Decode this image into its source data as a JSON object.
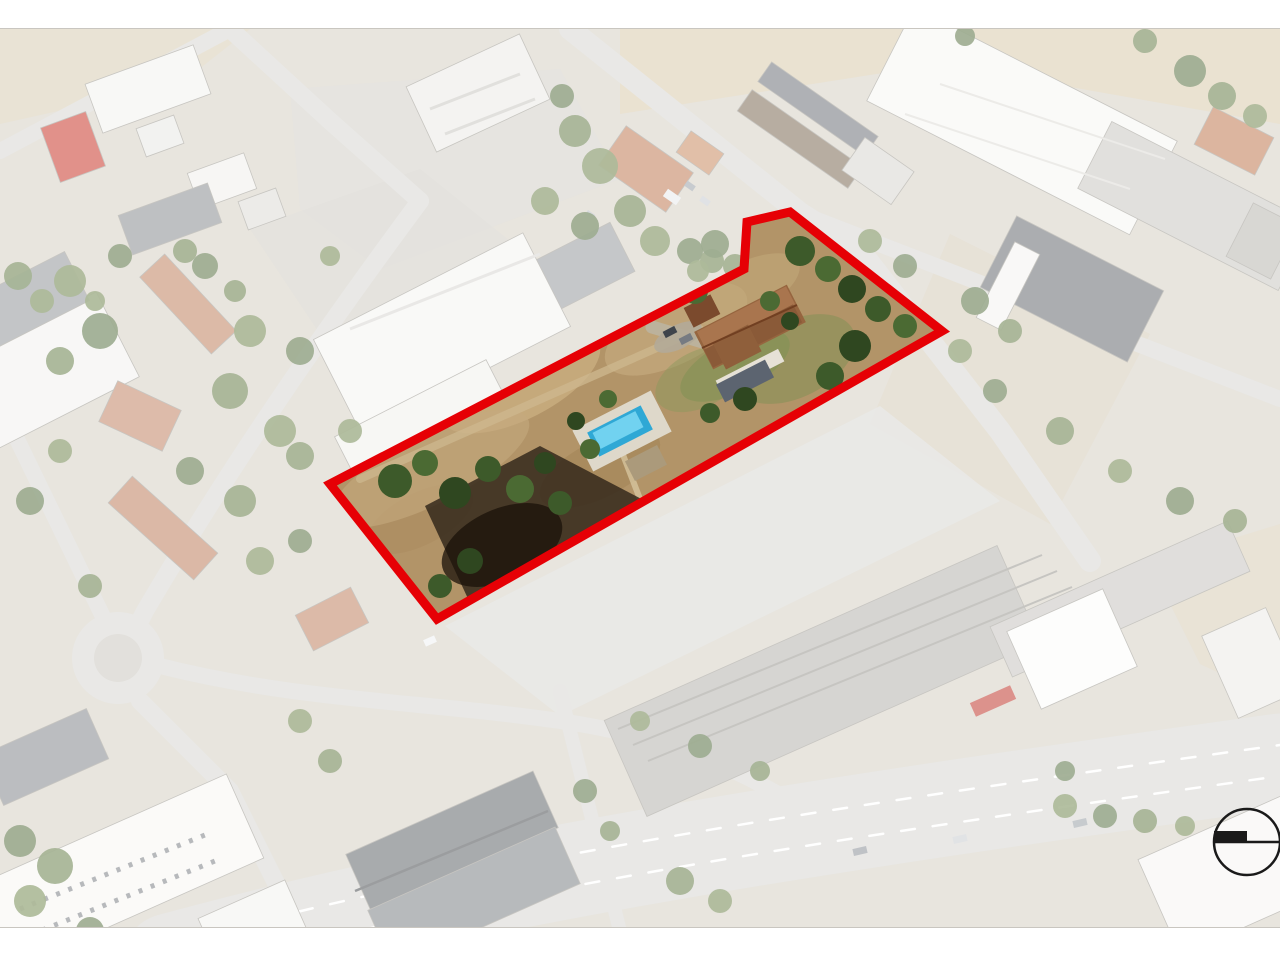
{
  "page": {
    "background": "#ffffff",
    "top_margin": 28,
    "bottom_margin": 32
  },
  "map": {
    "type": "aerial-photo",
    "base_color": "#d5cfc3",
    "washout": {
      "color": "#ffffff",
      "opacity": 0.45
    },
    "fields": [
      {
        "points": "620,0 1280,0 1280,95 940,35 620,85",
        "fill": "#d9c9a4",
        "op": 0.75
      },
      {
        "points": "0,0 250,0 180,55 0,95",
        "fill": "#d8cba8",
        "op": 0.6
      },
      {
        "points": "950,205 1150,305 1050,495 870,395",
        "fill": "#d3c6a6",
        "op": 0.45
      },
      {
        "points": "1150,535 1280,495 1280,672 1200,635",
        "fill": "#d8cba8",
        "op": 0.55
      },
      {
        "points": "290,60 560,40 620,150 380,240 300,180",
        "fill": "#cfcdc8",
        "op": 0.7
      },
      {
        "points": "250,200 420,140 520,220 330,320",
        "fill": "#ccc9c3",
        "op": 0.6
      },
      {
        "points": "445,597 880,377 1000,472 560,687",
        "fill": "#d8d7d3",
        "op": 0.9
      }
    ],
    "roads": [
      {
        "d": "M 570 0 L 800 184 L 860 222 L 1000 402 L 1090 532",
        "w": 22
      },
      {
        "d": "M 812 189 L 1280 370",
        "w": 16
      },
      {
        "d": "M 230 0 L 330 92 L 420 172",
        "w": 18
      },
      {
        "d": "M 0 122 L 230 0",
        "w": 16
      },
      {
        "d": "M 420 172 C 340 280 240 420 145 582 L 122 627",
        "w": 18
      },
      {
        "d": "M 0 375 L 122 627",
        "w": 16
      },
      {
        "d": "M 140 672 L 230 762 L 300 902",
        "w": 18
      },
      {
        "d": "M 160 637 C 300 672 420 672 560 692 C 700 712 780 762 850 812",
        "w": 16
      },
      {
        "d": "M 560 662 L 620 902",
        "w": 14
      },
      {
        "d": "M 430 898 C 650 856 900 818 1150 786",
        "w": 20
      },
      {
        "d": "M 170 932 C 500 842 850 792 1280 732",
        "w": 95
      }
    ],
    "road_color": "#d7d5d1",
    "lane_dashes": [
      {
        "d": "M 175 914 C 500 826 850 776 1280 716"
      },
      {
        "d": "M 180 947 C 505 857 855 807 1280 747"
      }
    ],
    "dash_color": "#ffffff",
    "roundabout": {
      "x": 118,
      "y": 629,
      "r_outer": 46,
      "r_inner": 24,
      "outer": "#d8d6d2",
      "inner": "#cbc7bf"
    },
    "buildings": [
      [
        148,
        60,
        115,
        52,
        -20,
        "#f3f2ef"
      ],
      [
        73,
        118,
        48,
        58,
        -20,
        "#c8372b"
      ],
      [
        160,
        107,
        40,
        30,
        -20,
        "#e8e7e3"
      ],
      [
        222,
        152,
        60,
        38,
        -20,
        "#f0efeb"
      ],
      [
        170,
        190,
        95,
        42,
        -20,
        "#898d91"
      ],
      [
        262,
        180,
        40,
        30,
        -20,
        "#dddbd6"
      ],
      [
        478,
        64,
        125,
        72,
        -25,
        "#eceae5"
      ],
      [
        646,
        140,
        82,
        48,
        35,
        "#bf7a55"
      ],
      [
        700,
        124,
        40,
        26,
        35,
        "#c98a62"
      ],
      [
        800,
        110,
        135,
        26,
        35,
        "#7d6b55"
      ],
      [
        818,
        80,
        130,
        24,
        35,
        "#6e7278"
      ],
      [
        878,
        142,
        60,
        40,
        35,
        "#d8d5cf"
      ],
      [
        1022,
        92,
        295,
        105,
        27,
        "#f6f6f3"
      ],
      [
        1195,
        177,
        225,
        75,
        27,
        "#c8c6c2"
      ],
      [
        1072,
        260,
        165,
        80,
        27,
        "#676b70"
      ],
      [
        1008,
        257,
        28,
        85,
        27,
        "#f4f3f0"
      ],
      [
        1234,
        112,
        68,
        42,
        27,
        "#c07850"
      ],
      [
        1262,
        212,
        50,
        60,
        27,
        "#b9b6b0"
      ],
      [
        520,
        270,
        230,
        55,
        -27,
        "#96999d"
      ],
      [
        442,
        304,
        235,
        105,
        -27,
        "#f5f4f1"
      ],
      [
        428,
        404,
        170,
        78,
        -27,
        "#f1f0ec"
      ],
      [
        42,
        344,
        170,
        95,
        -27,
        "#f2f1ee"
      ],
      [
        28,
        272,
        110,
        55,
        -27,
        "#92959a"
      ],
      [
        188,
        275,
        105,
        34,
        47,
        "#c08160"
      ],
      [
        140,
        387,
        70,
        45,
        25,
        "#c28365"
      ],
      [
        163,
        499,
        115,
        36,
        42,
        "#bd7e5e"
      ],
      [
        332,
        590,
        62,
        40,
        -27,
        "#c08162"
      ],
      [
        45,
        728,
        115,
        55,
        -24,
        "#84878c"
      ],
      [
        108,
        848,
        300,
        92,
        -24,
        "#f7f6f3"
      ],
      [
        252,
        894,
        95,
        52,
        -24,
        "#f3f2ee"
      ],
      [
        452,
        812,
        205,
        62,
        -24,
        "#62666a"
      ],
      [
        474,
        868,
        205,
        62,
        -24,
        "#7d8185"
      ],
      [
        822,
        652,
        430,
        105,
        -24,
        "#b4b2ae"
      ],
      [
        1120,
        570,
        260,
        55,
        -24,
        "#c6c4c0"
      ],
      [
        1072,
        620,
        105,
        85,
        -24,
        "#fbfbfa"
      ],
      [
        1252,
        634,
        70,
        90,
        -24,
        "#eceae5"
      ],
      [
        1237,
        844,
        170,
        105,
        -24,
        "#f6f5f2"
      ]
    ],
    "roof_lines": [
      {
        "d": "M 618 700 L 1042 526",
        "c": "#97958f",
        "w": 2
      },
      {
        "d": "M 633 716 L 1057 542",
        "c": "#97958f",
        "w": 2
      },
      {
        "d": "M 648 732 L 1072 558",
        "c": "#97958f",
        "w": 2
      },
      {
        "d": "M 940 55 L 1165 130",
        "c": "#dcdad5",
        "w": 2
      },
      {
        "d": "M 905 85 L 1130 160",
        "c": "#dcdad5",
        "w": 2
      },
      {
        "d": "M 355 862 L 548 782",
        "c": "#4a4d50",
        "w": 2.5
      },
      {
        "d": "M 20 880 L 205 806",
        "c": "#7d8085",
        "w": 5,
        "dash": "4 9"
      },
      {
        "d": "M 30 906 L 215 832",
        "c": "#7d8085",
        "w": 5,
        "dash": "4 9"
      },
      {
        "d": "M 350 300 L 540 225",
        "c": "#d8d6d1",
        "w": 3
      },
      {
        "d": "M 430 80 L 520 45",
        "c": "#c9c7c2",
        "w": 3
      },
      {
        "d": "M 445 105 L 535 70",
        "c": "#c9c7c2",
        "w": 3
      }
    ],
    "vehicles": [
      [
        690,
        157,
        10,
        6,
        35,
        "#9aa0a8"
      ],
      [
        705,
        172,
        10,
        6,
        35,
        "#c6cacf"
      ],
      [
        672,
        168,
        16,
        9,
        35,
        "#e8eaec"
      ],
      [
        590,
        186,
        9,
        6,
        35,
        "#b7bcc2"
      ],
      [
        430,
        612,
        12,
        7,
        -24,
        "#eef0f2"
      ],
      [
        860,
        822,
        14,
        7,
        -13,
        "#8b9097"
      ],
      [
        960,
        810,
        14,
        7,
        -13,
        "#c9ccd0"
      ],
      [
        1080,
        794,
        14,
        7,
        -13,
        "#9aa0a6"
      ],
      [
        993,
        672,
        44,
        15,
        -24,
        "#c03a2e"
      ]
    ],
    "trees": {
      "colors": [
        "#5e7740",
        "#6b8248",
        "#4f6a38"
      ],
      "items": [
        [
          18,
          247,
          14
        ],
        [
          42,
          272,
          12
        ],
        [
          205,
          237,
          13
        ],
        [
          235,
          262,
          11
        ],
        [
          330,
          227,
          10
        ],
        [
          562,
          67,
          12
        ],
        [
          575,
          102,
          16
        ],
        [
          600,
          137,
          18
        ],
        [
          585,
          197,
          14
        ],
        [
          630,
          182,
          16
        ],
        [
          655,
          212,
          15
        ],
        [
          690,
          222,
          13
        ],
        [
          712,
          232,
          12
        ],
        [
          545,
          172,
          14
        ],
        [
          715,
          215,
          14
        ],
        [
          735,
          237,
          12
        ],
        [
          698,
          242,
          11
        ],
        [
          120,
          227,
          12
        ],
        [
          185,
          222,
          12
        ],
        [
          95,
          272,
          10
        ],
        [
          1190,
          42,
          16
        ],
        [
          1222,
          67,
          14
        ],
        [
          1255,
          87,
          12
        ],
        [
          965,
          7,
          10
        ],
        [
          1145,
          12,
          12
        ],
        [
          960,
          322,
          12
        ],
        [
          995,
          362,
          12
        ],
        [
          1060,
          402,
          14
        ],
        [
          1120,
          442,
          12
        ],
        [
          1180,
          472,
          14
        ],
        [
          1235,
          492,
          12
        ],
        [
          70,
          252,
          16
        ],
        [
          100,
          302,
          18
        ],
        [
          60,
          332,
          14
        ],
        [
          250,
          302,
          16
        ],
        [
          300,
          322,
          14
        ],
        [
          230,
          362,
          18
        ],
        [
          280,
          402,
          16
        ],
        [
          190,
          442,
          14
        ],
        [
          240,
          472,
          16
        ],
        [
          60,
          422,
          12
        ],
        [
          30,
          472,
          14
        ],
        [
          90,
          557,
          12
        ],
        [
          260,
          532,
          14
        ],
        [
          300,
          512,
          12
        ],
        [
          300,
          427,
          14
        ],
        [
          350,
          402,
          12
        ],
        [
          20,
          812,
          16
        ],
        [
          55,
          837,
          18
        ],
        [
          30,
          872,
          16
        ],
        [
          90,
          902,
          14
        ],
        [
          330,
          732,
          12
        ],
        [
          300,
          692,
          12
        ],
        [
          585,
          762,
          12
        ],
        [
          610,
          802,
          10
        ],
        [
          640,
          692,
          10
        ],
        [
          700,
          717,
          12
        ],
        [
          760,
          742,
          10
        ],
        [
          1065,
          777,
          12
        ],
        [
          1105,
          787,
          12
        ],
        [
          1145,
          792,
          12
        ],
        [
          1185,
          797,
          10
        ],
        [
          1065,
          742,
          10
        ],
        [
          680,
          852,
          14
        ],
        [
          720,
          872,
          12
        ],
        [
          975,
          272,
          14
        ],
        [
          1010,
          302,
          12
        ],
        [
          870,
          212,
          12
        ],
        [
          905,
          237,
          12
        ]
      ]
    }
  },
  "parcel": {
    "outline_color": "#e60005",
    "outline_width": 9,
    "polygon": [
      [
        330,
        455
      ],
      [
        744,
        240
      ],
      [
        747,
        193
      ],
      [
        790,
        183
      ],
      [
        942,
        302
      ],
      [
        437,
        590
      ]
    ],
    "interior": {
      "ground_color": "#b29468",
      "patches": [
        [
          520,
          352,
          88,
          38,
          -27,
          "#c9ae80",
          0.8
        ],
        [
          600,
          440,
          66,
          28,
          -27,
          "#a5875a",
          0.7
        ],
        [
          676,
          300,
          78,
          34,
          -27,
          "#c5aa7d",
          0.7
        ],
        [
          420,
          490,
          58,
          26,
          -27,
          "#ab8c60",
          0.6
        ],
        [
          745,
          260,
          60,
          26,
          -27,
          "#c2a87a",
          0.6
        ],
        [
          430,
          440,
          110,
          35,
          -27,
          "#c4aa7e",
          0.6
        ]
      ],
      "paths": [
        {
          "d": "M 360 450 L 700 300",
          "c": "#cdb88f",
          "w": 8,
          "op": 0.75
        },
        {
          "d": "M 640 470 L 620 418",
          "c": "#d6c49e",
          "w": 6,
          "op": 0.8
        },
        {
          "d": "M 652 298 L 706 314",
          "c": "#bcb29c",
          "w": 13,
          "op": 1
        }
      ],
      "bramble": {
        "points": "425,477 540,417 655,477 638,519 470,574",
        "fill": "#2f2518",
        "op": 0.82
      },
      "bramble_blob": [
        502,
        516,
        64,
        36,
        -24,
        "#191209",
        0.75
      ],
      "garden": [
        [
          795,
          330,
          65,
          38,
          -27,
          "#7d9053",
          0.5
        ],
        [
          700,
          350,
          48,
          28,
          -27,
          "#87995c",
          0.45
        ],
        [
          735,
          337,
          60,
          26,
          -27,
          "#7f9154",
          0.55
        ],
        [
          678,
          308,
          26,
          12,
          -27,
          "#b3aa98",
          0.9
        ]
      ],
      "house_parts": [
        [
          750,
          298,
          104,
          42,
          -27,
          "#96653f"
        ],
        [
          746,
          289,
          100,
          20,
          -27,
          "#a9754e"
        ],
        [
          753,
          307,
          100,
          20,
          -27,
          "#8a5a38"
        ],
        [
          737,
          318,
          40,
          30,
          -27,
          "#8f5f3b"
        ],
        [
          750,
          342,
          70,
          14,
          -27,
          "#e6e1d6"
        ],
        [
          745,
          352,
          55,
          20,
          -27,
          "#5c6470"
        ],
        [
          702,
          282,
          30,
          22,
          -27,
          "#7b4a2d"
        ]
      ],
      "house_lines": [
        {
          "d": "M 702 319 L 797 276",
          "c": "#713f21",
          "w": 2
        }
      ],
      "pool_parts": [
        [
          622,
          402,
          88,
          46,
          -27,
          "#ded8ca"
        ],
        [
          620,
          402,
          60,
          27,
          -27,
          "#2fa8d5"
        ],
        [
          618,
          401,
          48,
          18,
          -27,
          "#71d2f0"
        ],
        [
          646,
          434,
          36,
          22,
          -27,
          "#ab9a7b"
        ]
      ],
      "vehicles": [
        [
          670,
          303,
          13,
          7,
          -27,
          "#3f444b"
        ],
        [
          686,
          310,
          13,
          7,
          -27,
          "#767b82"
        ]
      ],
      "trees": {
        "colors": [
          "#3d5a2a",
          "#4b6a33",
          "#2f4720"
        ],
        "items": [
          [
            395,
            452,
            17
          ],
          [
            425,
            434,
            13
          ],
          [
            455,
            464,
            16
          ],
          [
            488,
            440,
            13
          ],
          [
            520,
            460,
            14
          ],
          [
            545,
            434,
            11
          ],
          [
            560,
            474,
            12
          ],
          [
            590,
            420,
            10
          ],
          [
            470,
            532,
            13
          ],
          [
            440,
            557,
            12
          ],
          [
            608,
            370,
            9
          ],
          [
            576,
            392,
            9
          ],
          [
            652,
            272,
            8
          ],
          [
            695,
            262,
            13
          ],
          [
            722,
            244,
            11
          ],
          [
            800,
            222,
            15
          ],
          [
            828,
            240,
            13
          ],
          [
            852,
            260,
            14
          ],
          [
            878,
            280,
            13
          ],
          [
            905,
            297,
            12
          ],
          [
            855,
            317,
            16
          ],
          [
            830,
            347,
            14
          ],
          [
            862,
            367,
            12
          ],
          [
            745,
            370,
            12
          ],
          [
            710,
            384,
            10
          ],
          [
            770,
            272,
            10
          ],
          [
            790,
            292,
            9
          ]
        ]
      }
    }
  },
  "compass": {
    "cx": 1247,
    "cy": 813,
    "r": 33,
    "color": "#1a1a1a",
    "bar_w": 33,
    "bar_h": 11
  }
}
